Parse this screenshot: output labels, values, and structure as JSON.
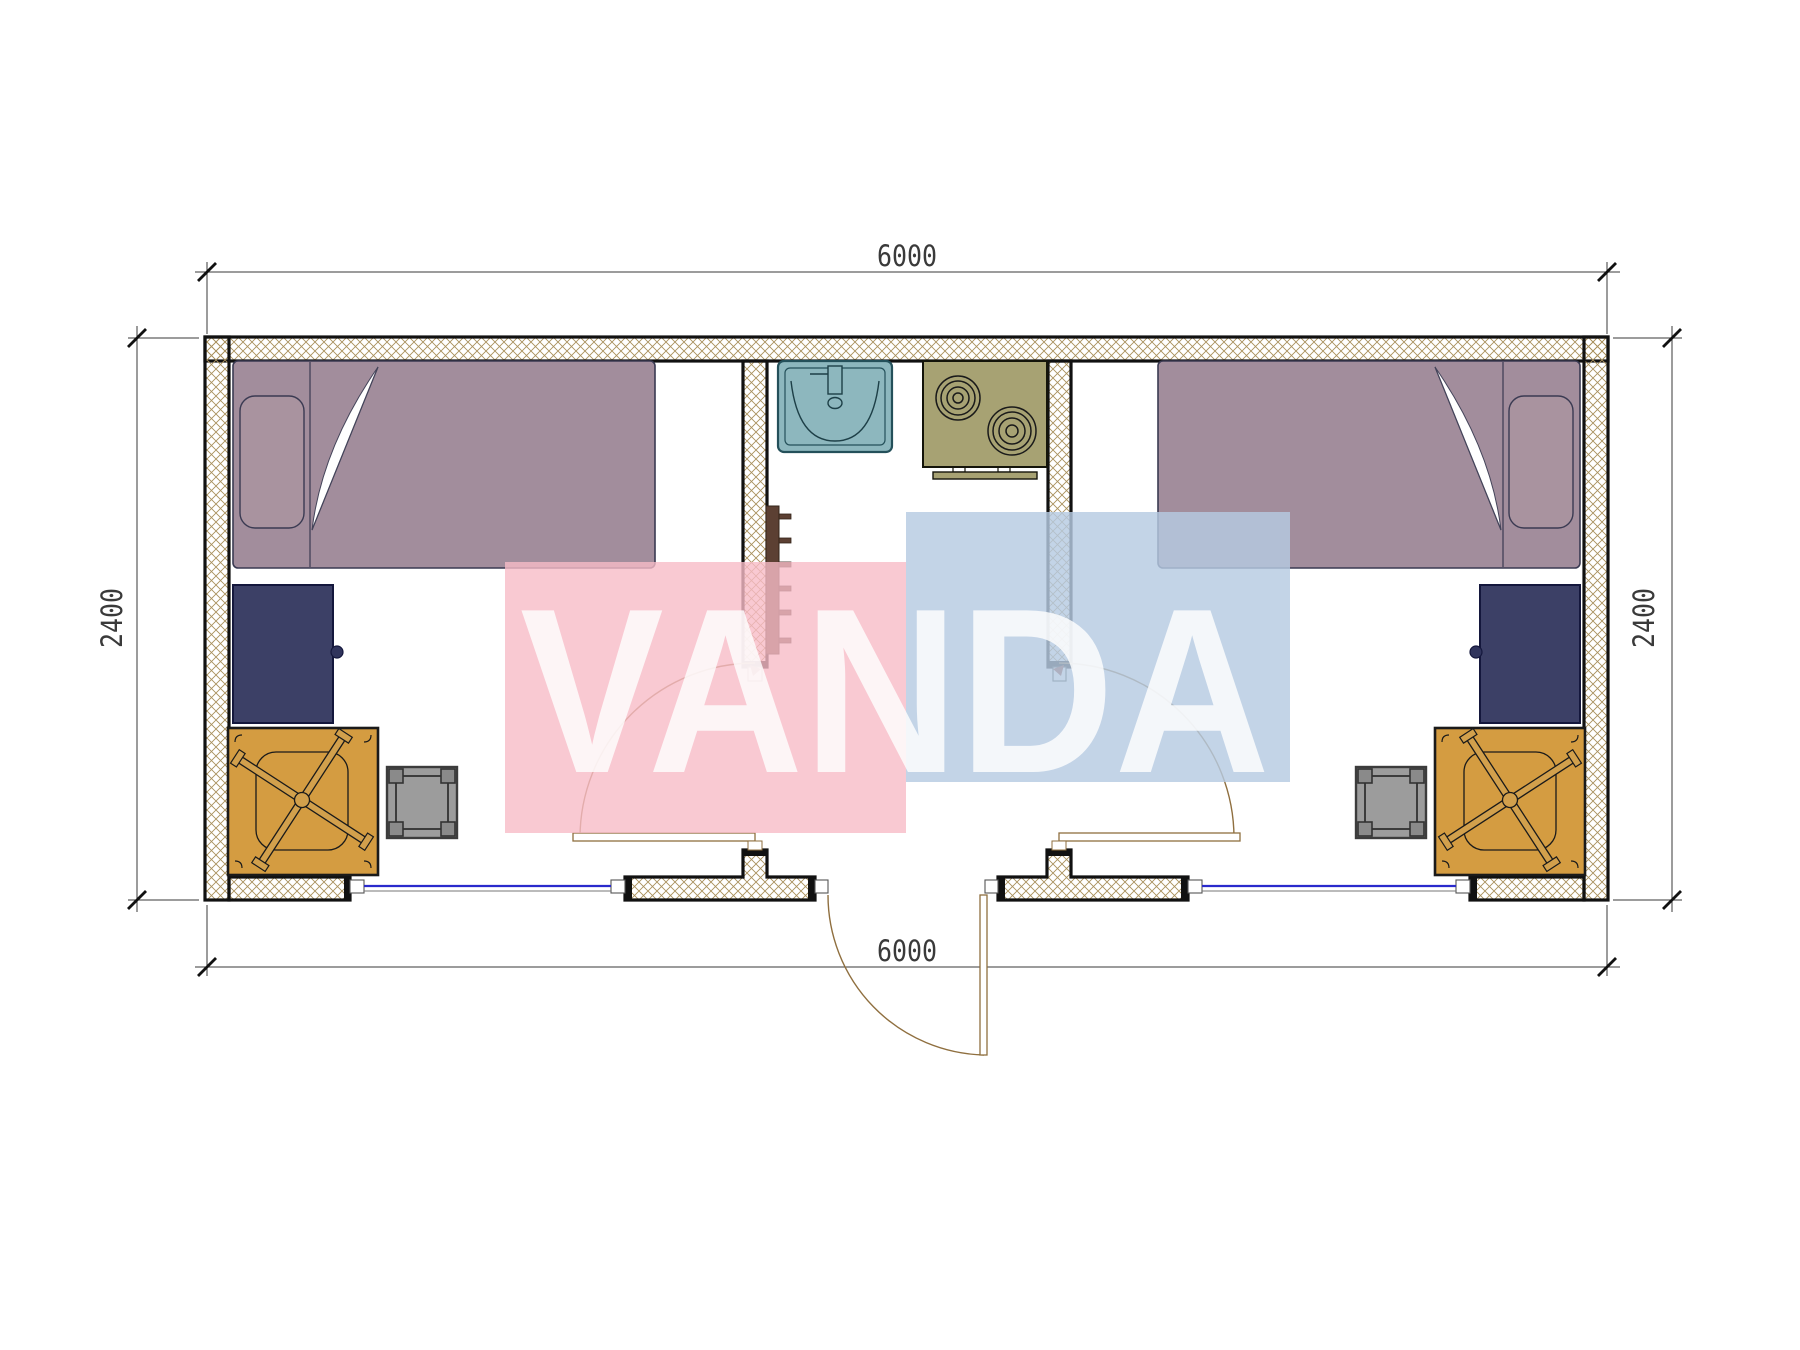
{
  "drawing": {
    "kind": "floor-plan",
    "background": "#ffffff",
    "description": "Plan of 6000x2400 modular cabin: two mirrored bedrooms flanking a central kitchen/entry"
  },
  "dimensions": {
    "top": "6000",
    "bottom": "6000",
    "left": "2400",
    "right": "2400"
  },
  "watermark": {
    "text": "VANDA",
    "pink_box_color": "#f7bcc7",
    "blue_box_color": "#b6cae2",
    "text_color": "#ffffff"
  },
  "colors": {
    "wall_hatch": "#a9905c",
    "wall_outline": "#111111",
    "bed": "#a28d9c",
    "pillow": "#a9939f",
    "bed_outline": "#3a3a52",
    "cabinet": "#3c4066",
    "cabinet_outline": "#14173c",
    "desk": "#d49c41",
    "chair": "#d2a04c",
    "stool": "#9c9c9c",
    "stool_corner": "#8a8a8a",
    "sink": "#8db7be",
    "sink_outline": "#24505a",
    "stove": "#a7a273",
    "radiator": "#5c4033",
    "window_line": "#2a2acc",
    "door_line": "#8f6f3f",
    "dimension_line": "#3a3a3a"
  },
  "furniture": {
    "left_room": [
      "single-bed",
      "wardrobe-cabinet",
      "desk-with-office-chair",
      "stool"
    ],
    "center": [
      "wash-basin",
      "two-burner-stove",
      "towel-radiator",
      "entry-door"
    ],
    "right_room": [
      "single-bed",
      "wardrobe-cabinet",
      "desk-with-office-chair",
      "stool"
    ]
  }
}
